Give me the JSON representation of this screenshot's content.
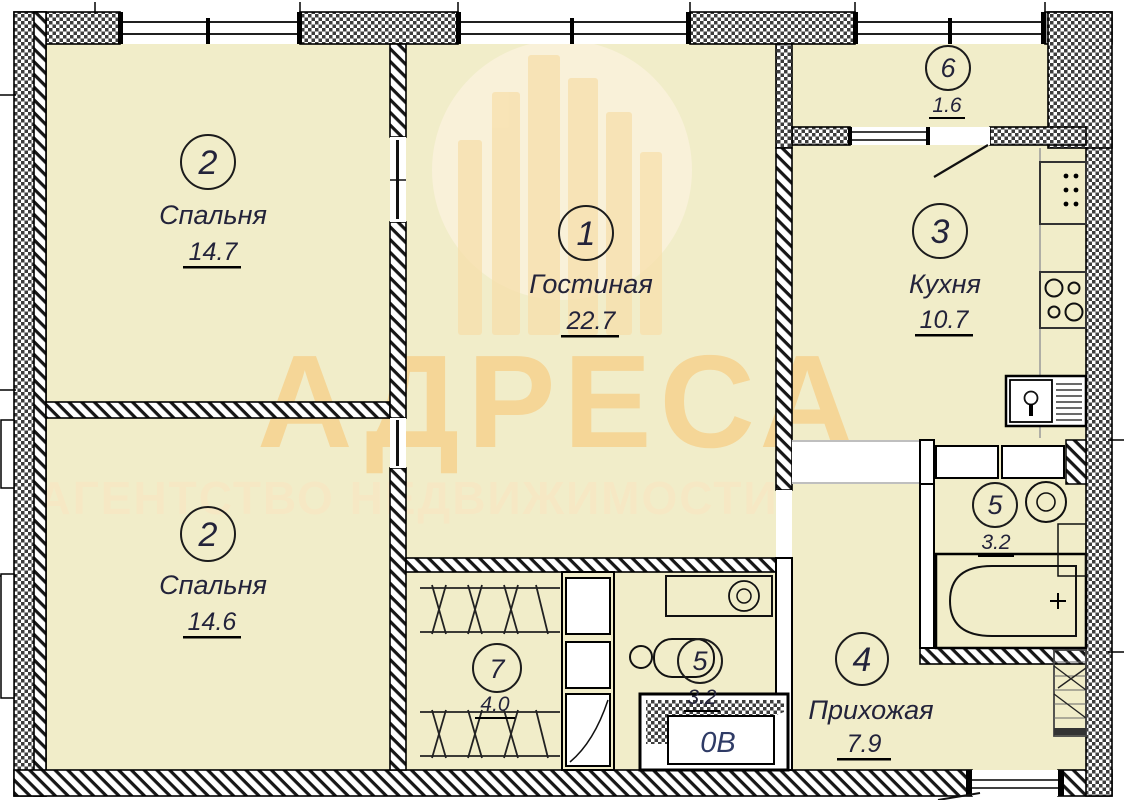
{
  "watermark": {
    "title": "АДРЕСА",
    "subtitle": "АГЕНТСТВО НЕДВИЖИМОСТИ"
  },
  "shaft": {
    "label": "0В"
  },
  "rooms": {
    "living": {
      "num": "1",
      "name": "Гостиная",
      "area": "22.7"
    },
    "bedroom_top": {
      "num": "2",
      "name": "Спальня",
      "area": "14.7"
    },
    "bedroom_bottom": {
      "num": "2",
      "name": "Спальня",
      "area": "14.6"
    },
    "kitchen": {
      "num": "3",
      "name": "Кухня",
      "area": "10.7"
    },
    "hallway": {
      "num": "4",
      "name": "Прихожая",
      "area": "7.9"
    },
    "bathroom": {
      "num": "5",
      "area": "3.2"
    },
    "wc": {
      "num": "5",
      "area": "3.2"
    },
    "balcony": {
      "num": "6",
      "area": "1.6"
    },
    "closet": {
      "num": "7",
      "area": "4.0"
    }
  },
  "colors": {
    "floor": "#f1edc9",
    "wall_line": "#000000",
    "watermark_title": "#f6d28f",
    "watermark_subtitle": "#f7e8c4",
    "watermark_logo": "#f7dfab",
    "watermark_disk": "#faf1da",
    "label_text": "#23233a",
    "shaft_text": "#2f3b66"
  }
}
